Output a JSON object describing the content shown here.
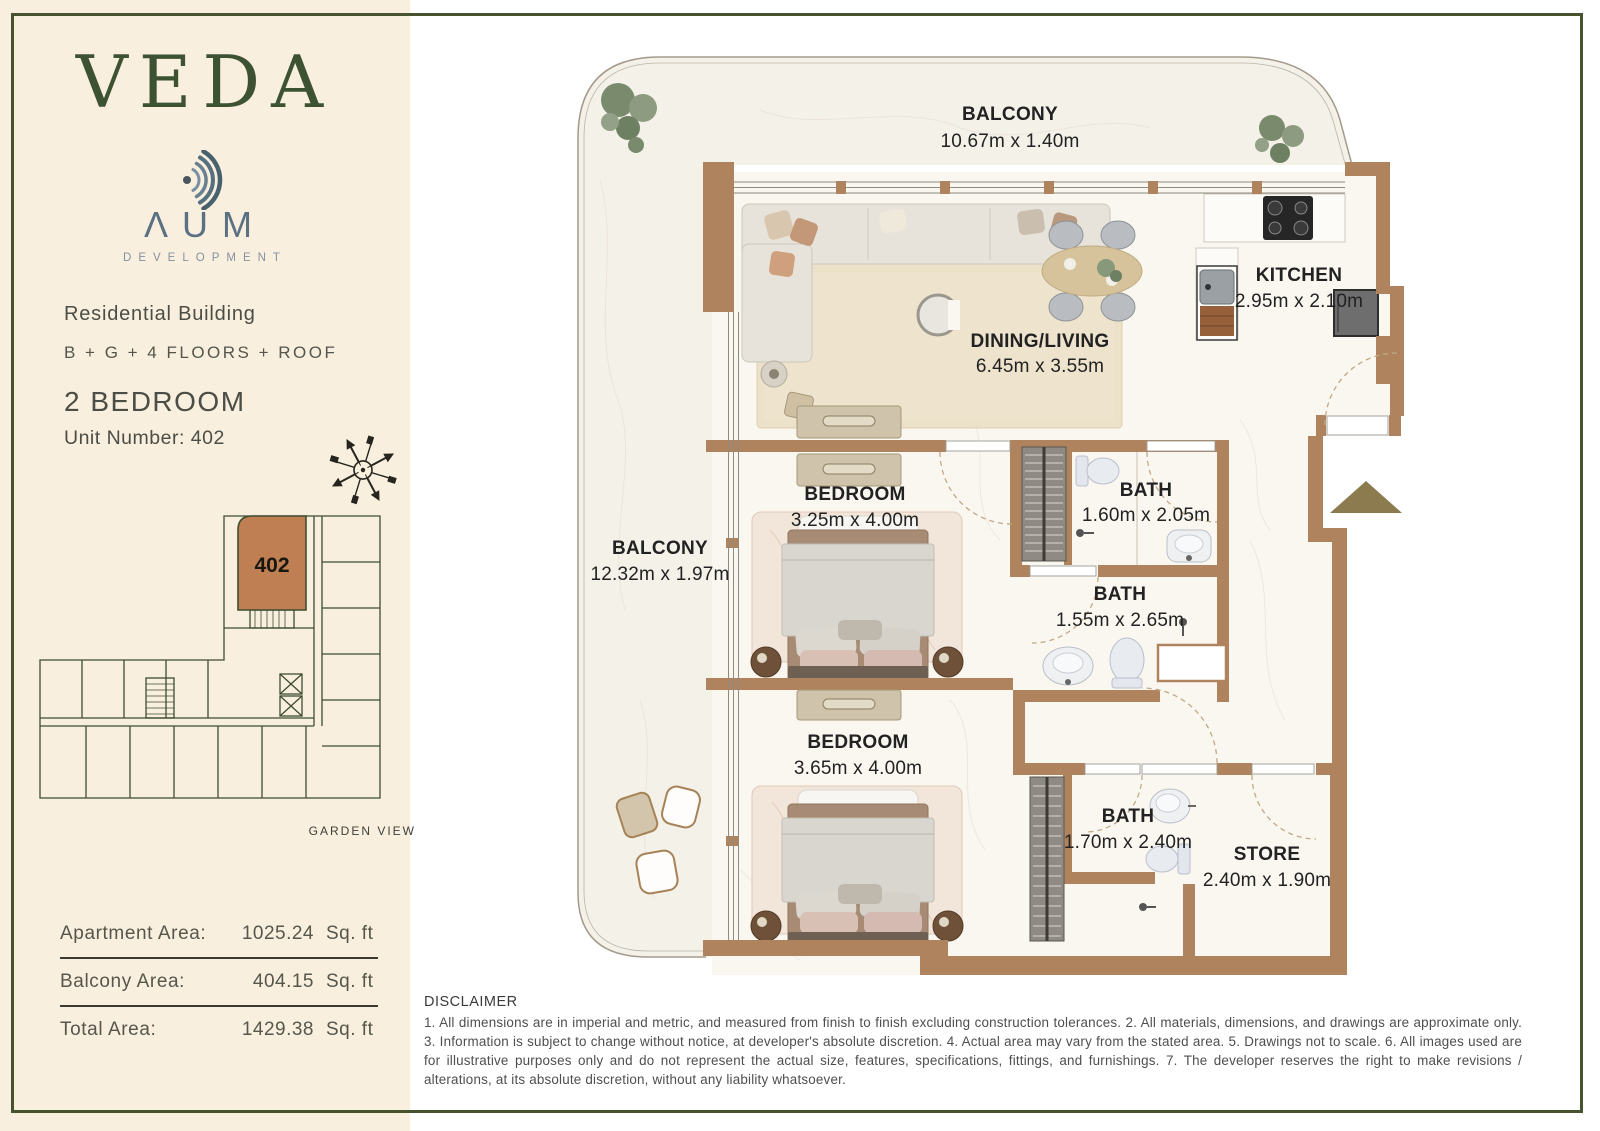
{
  "sidebar": {
    "brand": "VEDA",
    "developer": {
      "name": "ΛUM",
      "subtitle": "DEVELOPMENT"
    },
    "building": "Residential Building",
    "floors": "B + G + 4 FLOORS + ROOF",
    "unit_type": "2 BEDROOM",
    "unit_number": "Unit Number: 402",
    "key_plan": {
      "unit_label": "402",
      "view_label": "GARDEN VIEW"
    },
    "areas": [
      {
        "label": "Apartment Area:",
        "value": "1025.24",
        "unit": "Sq. ft"
      },
      {
        "label": "Balcony Area:",
        "value": "404.15",
        "unit": "Sq. ft"
      },
      {
        "label": "Total Area:",
        "value": "1429.38",
        "unit": "Sq. ft"
      }
    ]
  },
  "floor_plan": {
    "labels": {
      "balcony_top": {
        "name": "BALCONY",
        "dims": "10.67m x 1.40m"
      },
      "kitchen": {
        "name": "KITCHEN",
        "dims": "2.95m x 2.10m"
      },
      "dining_living": {
        "name": "DINING/LIVING",
        "dims": "6.45m x 3.55m"
      },
      "bedroom_1": {
        "name": "BEDROOM",
        "dims": "3.25m x 4.00m"
      },
      "bath_1": {
        "name": "BATH",
        "dims": "1.60m x 2.05m"
      },
      "balcony_left": {
        "name": "BALCONY",
        "dims": "12.32m x 1.97m"
      },
      "bath_2": {
        "name": "BATH",
        "dims": "1.55m x 2.65m"
      },
      "bedroom_2": {
        "name": "BEDROOM",
        "dims": "3.65m x 4.00m"
      },
      "bath_3": {
        "name": "BATH",
        "dims": "1.70m x 2.40m"
      },
      "store": {
        "name": "STORE",
        "dims": "2.40m x 1.90m"
      }
    }
  },
  "disclaimer": {
    "title": "DISCLAIMER",
    "body": "1. All dimensions are in imperial and metric, and measured from finish to finish excluding construction tolerances. 2. All materials, dimensions, and drawings are approximate only. 3. Information is subject to change without notice, at developer's absolute discretion. 4. Actual area may vary from the stated area. 5. Drawings not to scale. 6. All images used are for illustrative purposes only and do not represent the actual size, features, specifications, fittings, and furnishings. 7. The developer reserves the right to make revisions / alterations, at its absolute discretion, without any liability whatsoever."
  },
  "colors": {
    "accent_green": "#46532e",
    "logo_green": "#3d5233",
    "aum_blue": "#5b7183",
    "sidebar_bg": "#f8efde",
    "wall_brown": "#b0835f",
    "unit_highlight": "#bf7f52",
    "entry_arrow": "#8b7b4f"
  }
}
